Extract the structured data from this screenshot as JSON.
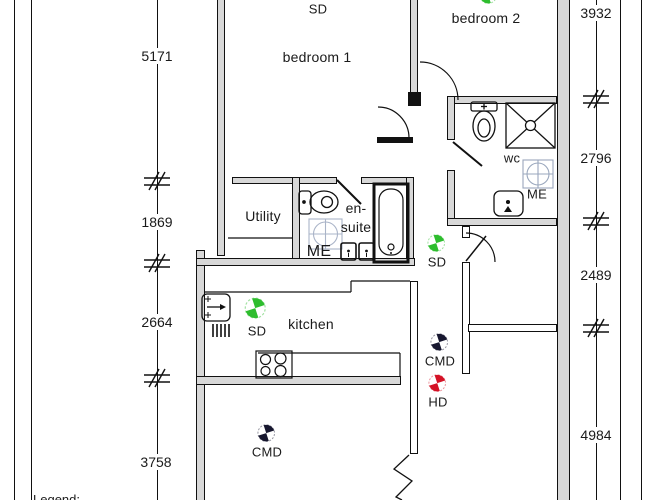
{
  "rooms": {
    "bedroom1": "bedroom 1",
    "bedroom2": "bedroom 2",
    "utility": "Utility",
    "ensuite_line1": "en-",
    "ensuite_line2": "suite",
    "wc": "wc",
    "kitchen": "kitchen"
  },
  "equipment": {
    "me_ensuite": "ME",
    "me_wc": "ME"
  },
  "detectors": [
    {
      "label": "SD",
      "type": "smoke-detector",
      "color": "#2ebd2e",
      "location": "bedroom 1"
    },
    {
      "label": "SD",
      "type": "smoke-detector",
      "color": "#2ebd2e",
      "location": "bedroom 2"
    },
    {
      "label": "SD",
      "type": "smoke-detector",
      "color": "#2ebd2e",
      "location": "kitchen"
    },
    {
      "label": "SD",
      "type": "smoke-detector",
      "color": "#2ebd2e",
      "location": "hallway"
    },
    {
      "label": "CMD",
      "type": "carbon-monoxide-detector",
      "color": "#17172f",
      "location": "hallway"
    },
    {
      "label": "HD",
      "type": "heat-detector",
      "color": "#d41226",
      "location": "hallway"
    },
    {
      "label": "CMD",
      "type": "carbon-monoxide-detector",
      "color": "#17172f",
      "location": "living room"
    }
  ],
  "dimensions": {
    "left": [
      "5171",
      "1869",
      "2664",
      "3758"
    ],
    "right": [
      "3932",
      "2796",
      "2489",
      "4984"
    ]
  },
  "legend": {
    "title": "Legend:"
  },
  "colors": {
    "wall_fill": "#d8d8d8",
    "sd_green": "#2ebd2e",
    "cmd_navy": "#17172f",
    "hd_red": "#d41226"
  }
}
